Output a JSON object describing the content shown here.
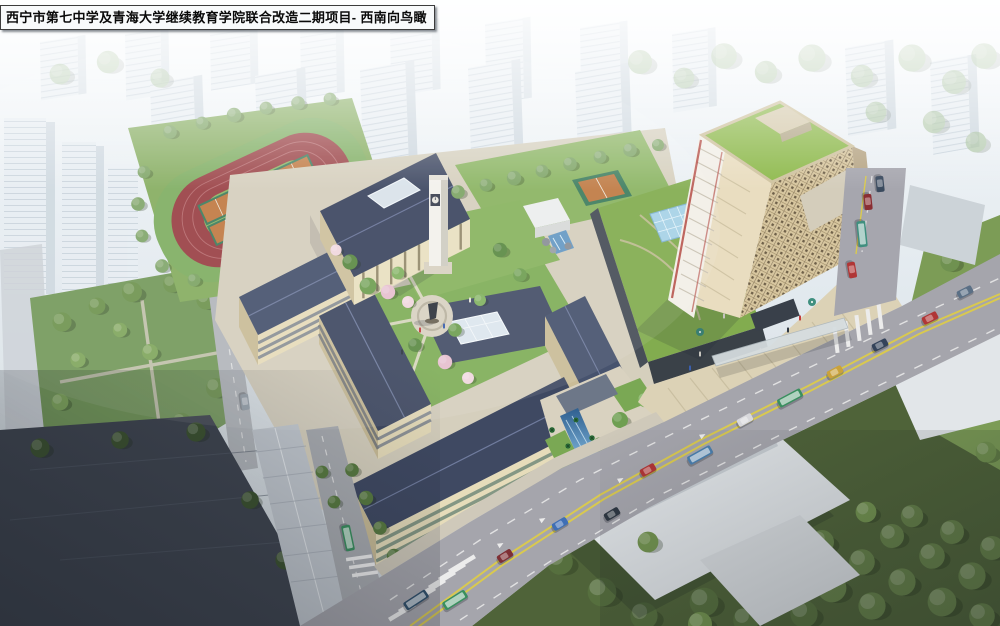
{
  "caption": {
    "text": "西宁市第七中学及青海大学继续教育学院联合改造二期项目- 西南向鸟瞰"
  },
  "scene": {
    "kind": "architectural-aerial-rendering",
    "view": "southwest-birds-eye",
    "landmarks": [
      {
        "name": "running-track",
        "label": "oval running track with six courts"
      },
      {
        "name": "basketball-courts",
        "label": "orange basketball courts"
      },
      {
        "name": "auditorium",
        "label": "columned assembly hall"
      },
      {
        "name": "clock-tower",
        "label": "white campus clock tower"
      },
      {
        "name": "school-buildings",
        "label": "classroom wings around courtyard"
      },
      {
        "name": "statue-plaza",
        "label": "circular plaza with statue"
      },
      {
        "name": "entrance-axis",
        "label": "entrance gate with reflecting pool"
      },
      {
        "name": "highrise-tower",
        "label": "continuing education tower, green roof"
      },
      {
        "name": "glass-pyramid-skylight",
        "label": "blue glass skylight on podium"
      },
      {
        "name": "tower-plaza",
        "label": "stepped plaza with umbrellas"
      },
      {
        "name": "pedestrian-bridge",
        "label": "footbridge over arterial road"
      },
      {
        "name": "main-road",
        "label": "arterial road with traffic"
      },
      {
        "name": "north-road",
        "label": "cross street at right"
      },
      {
        "name": "city-background",
        "label": "hazy residential blocks"
      }
    ],
    "palette": {
      "sky_haze": "#eef3f7",
      "track_red": "#9a4145",
      "court_orange": "#bf7a43",
      "court_green": "#3e7d5e",
      "lawn_green": "#7fae5a",
      "tree_green": "#6f9f52",
      "blossom_pink": "#e6bfcf",
      "roof_slate": "#3f4962",
      "wall_cream": "#e6dcba",
      "tower_facade": "#d7c69f",
      "tower_roof_green": "#8fba4e",
      "tower_accent_red": "#b04038",
      "glass_blue": "#a7d2e6",
      "road_gray": "#a5a5ac",
      "road_line_yellow": "#d9c94f",
      "water_blue": "#4a7fae"
    }
  }
}
